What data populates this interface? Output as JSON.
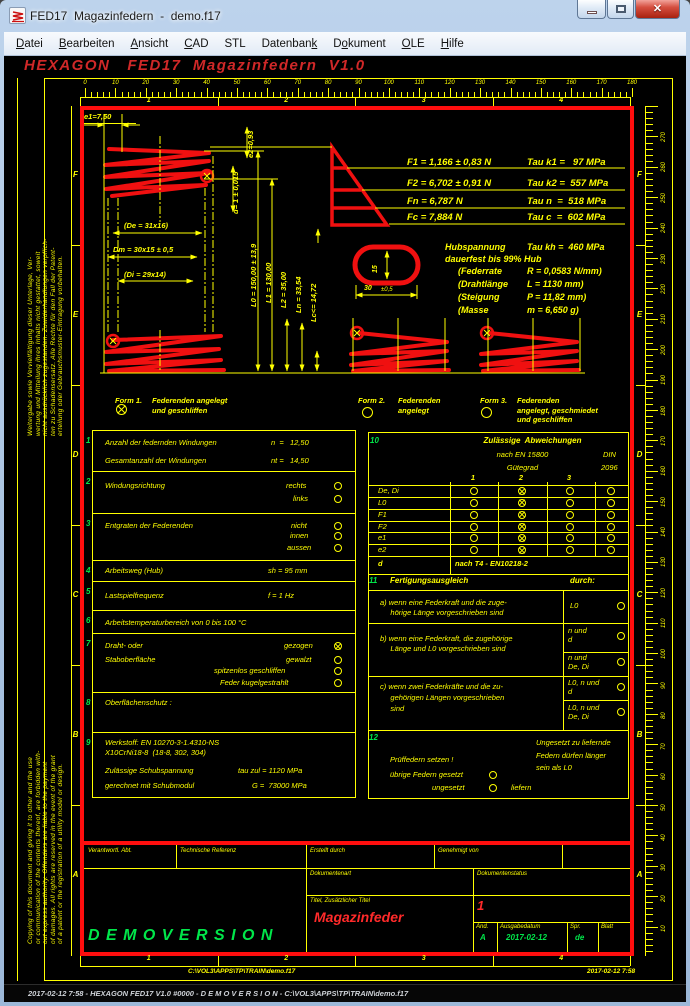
{
  "window": {
    "title": "FED17  Magazinfedern  -  demo.f17"
  },
  "menu": {
    "items": [
      {
        "label": "Datei",
        "u": 0
      },
      {
        "label": "Bearbeiten",
        "u": 0
      },
      {
        "label": "Ansicht",
        "u": 0
      },
      {
        "label": "CAD",
        "u": 0
      },
      {
        "label": "STL",
        "u": -1
      },
      {
        "label": "Datenbank",
        "u": 8
      },
      {
        "label": "Dokument",
        "u": 1
      },
      {
        "label": "OLE",
        "u": 0
      },
      {
        "label": "Hilfe",
        "u": 0
      }
    ]
  },
  "heading": "HEXAGON   FED17  Magazinfedern  V1.0",
  "rulers": {
    "top_labels": [
      "0",
      "10",
      "20",
      "30",
      "40",
      "50",
      "60",
      "70",
      "80",
      "90",
      "100",
      "110",
      "120",
      "130",
      "140",
      "150",
      "160",
      "170",
      "180"
    ],
    "right_labels": [
      "270",
      "260",
      "250",
      "240",
      "230",
      "220",
      "210",
      "200",
      "190",
      "180",
      "170",
      "160",
      "150",
      "140",
      "130",
      "120",
      "110",
      "100",
      "90",
      "80",
      "70",
      "60",
      "50",
      "40",
      "30",
      "20",
      "10"
    ],
    "row_letters": [
      "F",
      "E",
      "D",
      "C",
      "B",
      "A"
    ],
    "col_numbers": [
      "1",
      "2",
      "3",
      "4"
    ]
  },
  "forces": {
    "rows": [
      {
        "f": "F1 = 1,166 ± 0,83 N",
        "tau": "Tau k1 =   97 MPa"
      },
      {
        "f": "F2 = 6,702 ± 0,91 N",
        "tau": "Tau k2 =  557 MPa"
      },
      {
        "f": "Fn = 6,787 N",
        "tau": "Tau n  =  518 MPa"
      },
      {
        "f": "Fc = 7,884 N",
        "tau": "Tau c  =  602 MPa"
      }
    ]
  },
  "hub": {
    "title_left": "Hubspannung",
    "title_right": "Tau kh =  460 MPa",
    "subtitle": "dauerfest bis 99% Hub",
    "rows": [
      {
        "k": "(Federrate",
        "v": "R = 0,0583 N/mm)"
      },
      {
        "k": "(Drahtlänge",
        "v": "L = 1130 mm)"
      },
      {
        "k": "(Steigung",
        "v": "P = 11,82 mm)"
      },
      {
        "k": "(Masse",
        "v": "m = 6,650 g)"
      }
    ]
  },
  "dims": {
    "e1": "e1=7,50",
    "e2": "e2=0,93",
    "d": "d= 1 ± 0,015",
    "de": "(De = 31x16)",
    "dm": "Dm = 30x15 ± 0,5",
    "di": "(Di = 29x14)",
    "L0": "L0 = 150,00 ± 13,9",
    "L1": "L1 = 130,00",
    "L2": "L2 = 35,00",
    "Ln": "Ln = 33,54",
    "Lc": "Lc<= 14,72",
    "cs_h": "15",
    "cs_w": "30",
    "cs_tol": "±0,5"
  },
  "forms": {
    "f1_name": "Form 1.",
    "f1_desc": "Federenden angelegt\nund geschliffen",
    "f2_name": "Form 2.",
    "f2_desc": "Federenden\nangelegt",
    "f3_name": "Form 3.",
    "f3_desc": "Federenden\nangelegt, geschmiedet\nund geschliffen"
  },
  "spec": {
    "numbers": [
      "1",
      "2",
      "3",
      "4",
      "5",
      "6",
      "7",
      "8",
      "9"
    ],
    "r1a_label": "Anzahl der federnden Windungen",
    "r1a_val": "n  =   12,50",
    "r1b_label": "Gesamtanzahl der Windungen",
    "r1b_val": "nt =   14,50",
    "r2_label": "Windungsrichtung",
    "r2_opt1": "rechts",
    "r2_opt2": "links",
    "r3_label": "Entgraten der Federenden",
    "r3_opt1": "nicht",
    "r3_opt2": "innen",
    "r3_opt3": "aussen",
    "r4_label": "Arbeitsweg (Hub)",
    "r4_val": "sh = 95 mm",
    "r5_label": "Lastspielfrequenz",
    "r5_val": "f = 1 Hz",
    "r6_label": "Arbeitstemperaturbereich von 0 bis 100 °C",
    "r7_label1": "Draht- oder",
    "r7_label2": "Staboberfläche",
    "r7_opt1": "gezogen",
    "r7_opt2": "gewalzt",
    "r7_opt3": "spitzenlos geschliffen",
    "r7_opt4": "Feder kugelgestrahlt",
    "r8_label": "Oberflächenschutz :",
    "r9_line1": "Werkstoff: EN 10270-3-1.4310-NS",
    "r9_line2": "X10CrNi18-8  (18-8, 302, 304)",
    "r9_line3": "Zulässige Schubspannung",
    "r9_val3": "tau zul = 1120 MPa",
    "r9_line4": "gerechnet mit Schubmodul",
    "r9_val4": "G =  73000 MPa"
  },
  "abw": {
    "number": "10",
    "title": "Zulässige  Abweichungen",
    "subtitle": "nach EN 15800",
    "grade": "Gütegrad",
    "din1": "DIN",
    "din2": "2096",
    "cols": [
      "1",
      "2",
      "3"
    ],
    "rows": [
      "De, Di",
      "L0",
      "F1",
      "F2",
      "e1",
      "e2"
    ],
    "d_label": "d",
    "d_value": "nach T4 - EN10218-2"
  },
  "ausgleich": {
    "number": "11",
    "title": "Fertigungsausgleich",
    "durch": "durch:",
    "a_text": "a) wenn eine Federkraft und die zuge-\n     hörige Länge vorgeschrieben sind",
    "a_opt": "L0",
    "b_text": "b) wenn eine Federkraft, die zugehörige\n     Länge und L0 vorgeschrieben sind",
    "b_opt1": "n und\nd",
    "b_opt2": "n und\nDe, Di",
    "c_text": "c) wenn zwei Federkräfte und die zu-\n     gehörigen Längen vorgeschrieben\n     sind",
    "c_opt1": "L0, n und\nd",
    "c_opt2": "L0, n und\nDe, Di"
  },
  "pruef": {
    "number": "12",
    "note": "Ungesetzt zu liefernde\nFedern dürfen länger\nsein als L0",
    "line1": "Prüffedern setzen !",
    "line2": "übrige Federn gesetzt",
    "line3": "ungesetzt",
    "line4": "liefern"
  },
  "tb": {
    "verantwortl": "Verantwortl. Abt.",
    "techref": "Technische Referenz",
    "erstellt": "Erstellt durch",
    "genehmigt": "Genehmigt von",
    "dokart": "Dokumentenart",
    "dokstatus": "Dokumentenstatus",
    "titel_label": "Titel, Zusätzlicher Titel",
    "titel": "Magazinfeder",
    "page": "1",
    "aend_label": "Änd.",
    "aend": "A",
    "ausgabe_label": "Ausgabedatum",
    "ausgabe": "2017-02-12",
    "spr_label": "Spr.",
    "spr": "de",
    "blatt_label": "Blatt",
    "demo": "D E M O V E R S I O N"
  },
  "footer": {
    "path": "C:\\VOL3\\APPS\\TP\\TRAIN\\demo.f17",
    "time": "2017-02-12 7:58"
  },
  "statusbar": {
    "text": "2017-02-12 7:58 - HEXAGON FED17 V1.0 #0000 - D E M O V E R S I O N - C:\\VOL3\\APPS\\TP\\TRAIN\\demo.f17"
  },
  "disclaimers": {
    "de": "Weitergabe sowie Vervielfältigung dieser Unterlage, Ver-\nwertung und Mitteilung ihres Inhalts nicht gestattet, soweit\nnicht ausdrücklich zugestanden. Zuwiderhandlungen verpflich-\nten zu Schadensersatz. Alle Rechte für den Fall der Patent-\nerteilung oder Gebrauchsmuster-Eintragung vorbehalten.",
    "en": "Copying of this document and giving it to other and the use\nor communication of the contents thereof, are forbidden with-\nout express authority. Offenders are liable to the payment\nof damages. All rights are reserved in the event of the grant\nof a patent or the registration of a utility model or design."
  }
}
